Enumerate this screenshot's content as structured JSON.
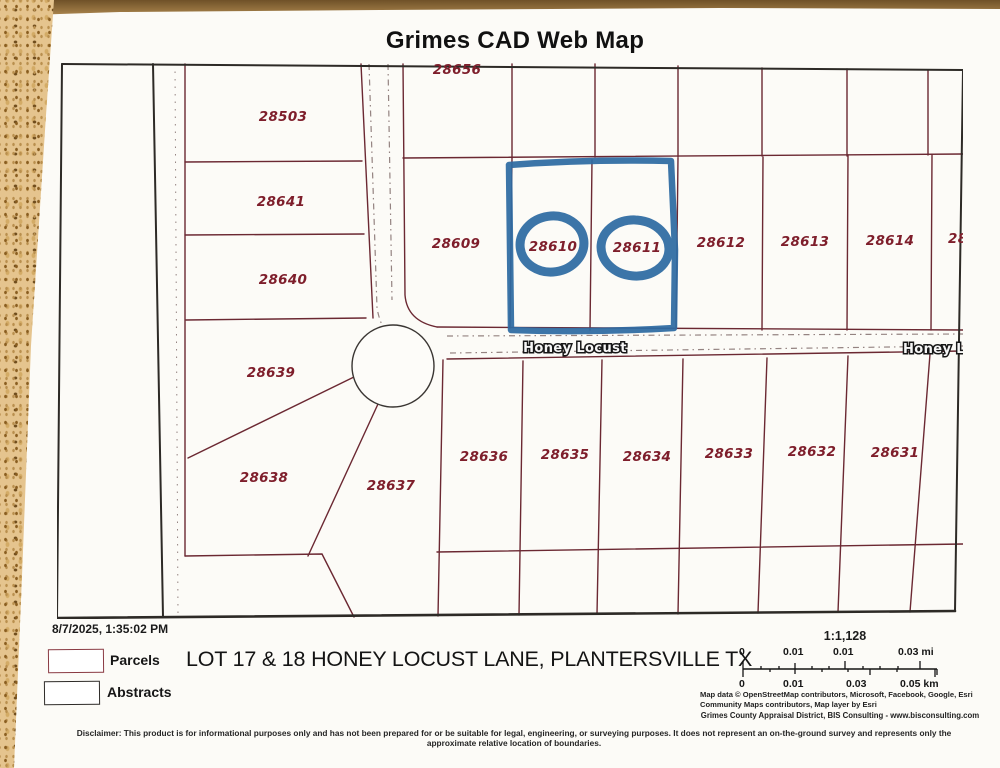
{
  "title": "Grimes CAD Web Map",
  "map": {
    "street": {
      "label": "Honey Locust",
      "label_right_clipped": "Honey Loc"
    },
    "parcels": [
      {
        "id": "28503"
      },
      {
        "id": "28641"
      },
      {
        "id": "28640"
      },
      {
        "id": "28639"
      },
      {
        "id": "28638"
      },
      {
        "id": "28637"
      },
      {
        "id": "28609"
      },
      {
        "id": "28610",
        "highlighted": true
      },
      {
        "id": "28611",
        "highlighted": true
      },
      {
        "id": "28612"
      },
      {
        "id": "28613"
      },
      {
        "id": "28614"
      },
      {
        "id": "28636"
      },
      {
        "id": "28635"
      },
      {
        "id": "28634"
      },
      {
        "id": "28633"
      },
      {
        "id": "28632"
      },
      {
        "id": "28631"
      },
      {
        "id": "28656",
        "clipped": "top"
      },
      {
        "id": "28",
        "clipped": "right"
      }
    ],
    "colors": {
      "parcel_line": "#6b2832",
      "parcel_label": "#7e1e2b",
      "abstract_line": "#2d2a26",
      "highlight_marker": "#2e6ba3"
    }
  },
  "footer": {
    "timestamp": "8/7/2025, 1:35:02 PM",
    "legend": [
      {
        "label": "Parcels"
      },
      {
        "label": "Abstracts"
      }
    ],
    "address": "LOT 17 & 18 HONEY LOCUST LANE, PLANTERSVILLE TX",
    "scale": {
      "ratio": "1:1,128",
      "mi": [
        "0",
        "0.01",
        "0.01",
        "0.03 mi"
      ],
      "km": [
        "0",
        "0.01",
        "0.03",
        "0.05 km"
      ]
    },
    "credits_line1": "Map data © OpenStreetMap contributors, Microsoft, Facebook, Google, Esri Community Maps contributors, Map layer by Esri",
    "credits_line2": "Grimes County Appraisal District, BIS Consulting - www.bisconsulting.com",
    "disclaimer": "Disclaimer: This product is for informational purposes only and has not been prepared for or be suitable for legal, engineering, or surveying purposes. It does not represent an on-the-ground survey and represents only the approximate relative location of boundaries."
  }
}
